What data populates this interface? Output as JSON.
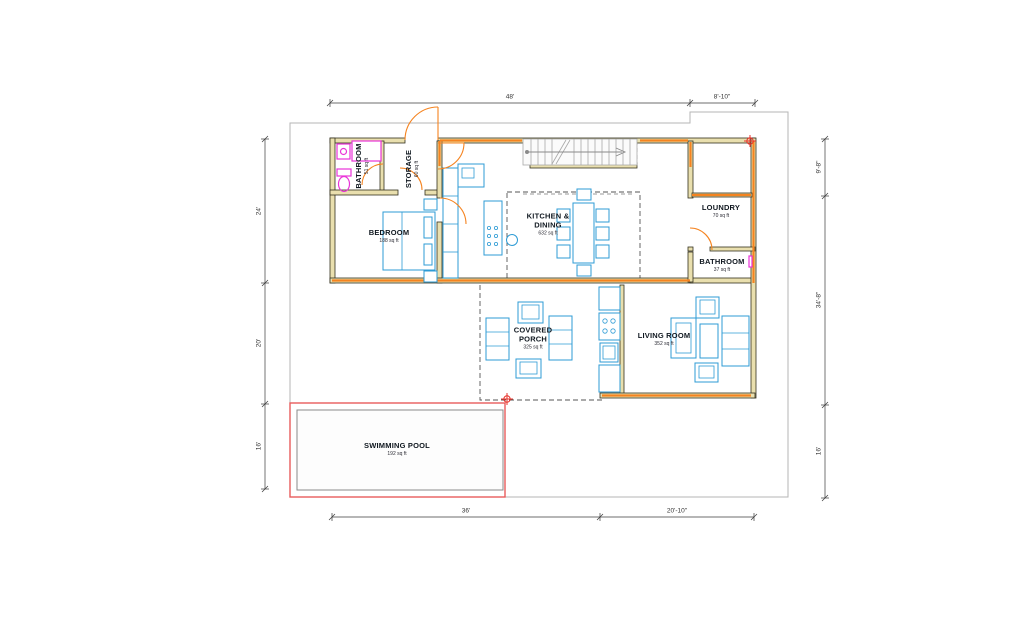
{
  "rooms": {
    "bathroom_main": {
      "name": "BATHROOM",
      "area": "51 sq ft"
    },
    "storage": {
      "name": "STORAGE",
      "area": "60 sq ft"
    },
    "bedroom": {
      "name": "BEDROOM",
      "area": "188 sq ft"
    },
    "kitchen_dining": {
      "name": "KITCHEN & DINING",
      "area": "632 sq ft"
    },
    "loundry": {
      "name": "LOUNDRY",
      "area": "70 sq ft"
    },
    "bathroom_second": {
      "name": "BATHROOM",
      "area": "37 sq ft"
    },
    "covered_porch": {
      "name": "COVERED PORCH",
      "area": "325 sq ft"
    },
    "living_room": {
      "name": "LIVING ROOM",
      "area": "352 sq ft"
    },
    "swimming_pool": {
      "name": "SWIMMING POOL",
      "area": "192 sq ft"
    }
  },
  "dimensions": {
    "top": [
      "48'",
      "8'-10\""
    ],
    "bottom": [
      "36'",
      "20'-10\""
    ],
    "left": [
      "24'",
      "20'",
      "16'"
    ],
    "right": [
      "9'-8\"",
      "34'-8\"",
      "16'"
    ]
  },
  "colors": {
    "wall-fill": "#e9dfae",
    "wall-edge": "#33301f",
    "orange": "#f5831f",
    "blue": "#2d9bd5",
    "blue-light": "#d9eefb",
    "magenta": "#ea33d8",
    "pool-red": "#e85c5c",
    "boundary": "#b5b5b5",
    "stair": "#a8a8a8",
    "dim": "#3c3c3c",
    "label": "#101820"
  }
}
